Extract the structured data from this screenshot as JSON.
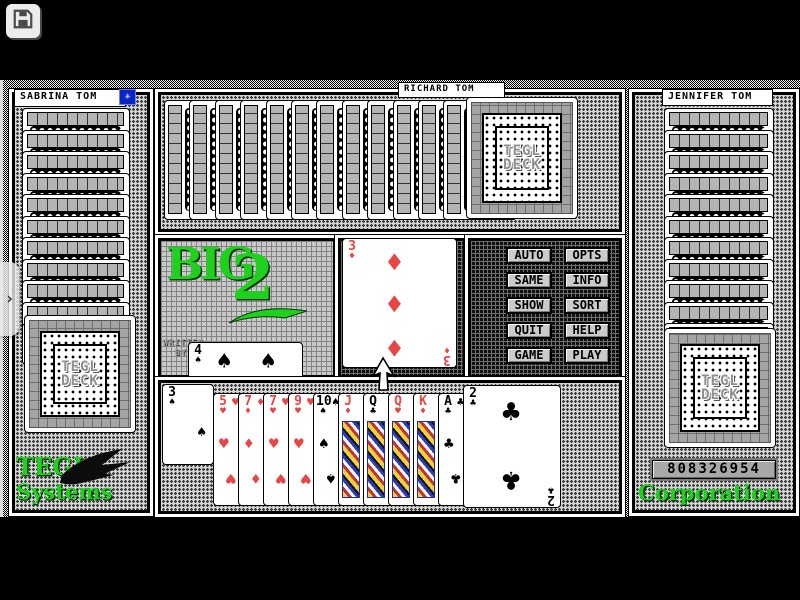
{
  "title": "BIG 2 card game (TEGL)",
  "toolbar": {
    "save_icon": "floppy-disk"
  },
  "players": {
    "left": {
      "name": "SABRINA TOM",
      "cards": 11,
      "turn_star": "✳"
    },
    "top": {
      "name": "RICHARD TOM",
      "cards": 12
    },
    "right": {
      "name": "JENNIFER TOM",
      "cards": 12
    }
  },
  "logo": {
    "big": "BIG",
    "two": "2",
    "written_by": [
      "WRITTEN",
      "BY"
    ]
  },
  "deck": {
    "label": [
      "TEGL",
      "DECK"
    ]
  },
  "brand": {
    "left": [
      "TEGL",
      "Systems"
    ],
    "right": "Corporation"
  },
  "score": "808326954",
  "menu_buttons": [
    "AUTO",
    "OPTS",
    "SAME",
    "INFO",
    "SHOW",
    "SORT",
    "QUIT",
    "HELP",
    "GAME",
    "PLAY"
  ],
  "table_card": {
    "rank": "3",
    "suit": "diamonds"
  },
  "side_card": {
    "rank": "4",
    "suit": "spades"
  },
  "hand": [
    {
      "rank": "3",
      "suit": "spades"
    },
    {
      "rank": "5",
      "suit": "hearts"
    },
    {
      "rank": "7",
      "suit": "diamonds"
    },
    {
      "rank": "7",
      "suit": "hearts"
    },
    {
      "rank": "9",
      "suit": "hearts"
    },
    {
      "rank": "10",
      "suit": "spades"
    },
    {
      "rank": "J",
      "suit": "diamonds"
    },
    {
      "rank": "Q",
      "suit": "clubs"
    },
    {
      "rank": "Q",
      "suit": "hearts"
    },
    {
      "rank": "K",
      "suit": "diamonds"
    },
    {
      "rank": "A",
      "suit": "clubs"
    },
    {
      "rank": "2",
      "suit": "clubs"
    }
  ],
  "side_toggle_glyph": "›",
  "colors": {
    "red_suit": "#e84545",
    "black_suit": "#000000",
    "brand_green": "#1dd11d",
    "turn_blue": "#0a24c8"
  }
}
